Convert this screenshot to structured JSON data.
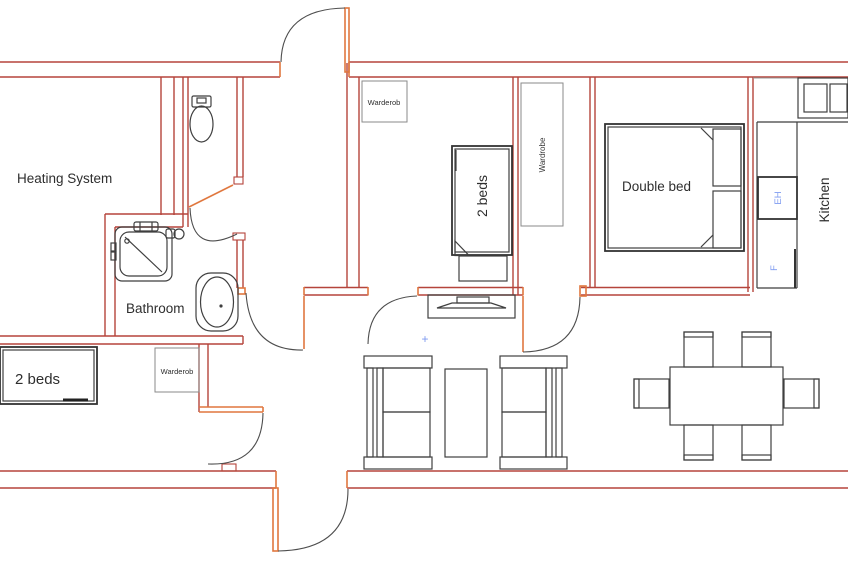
{
  "colors": {
    "wall": "#b5443b",
    "door_leaf": "#e0773f",
    "door_swing": "#4d4d4d",
    "furniture": "#3f3f3f",
    "box_outline": "#8a8a8a",
    "accent_blue": "#7d9af0",
    "text": "#2e2e2e",
    "background": "#ffffff"
  },
  "labels": {
    "heating_room": "Heating System",
    "bathroom": "Bathroom",
    "bed_small_left": "2 beds",
    "bed_small_middle": "2 beds",
    "double_bed": "Double bed",
    "kitchen": "Kitchen",
    "wardrobe_hall": "Warderob",
    "wardrobe_bedroom": "Warderob",
    "wardrobe_corridor": "Wardrobe",
    "electric_hob": "EH",
    "fridge": "F",
    "center_mark": "+"
  }
}
